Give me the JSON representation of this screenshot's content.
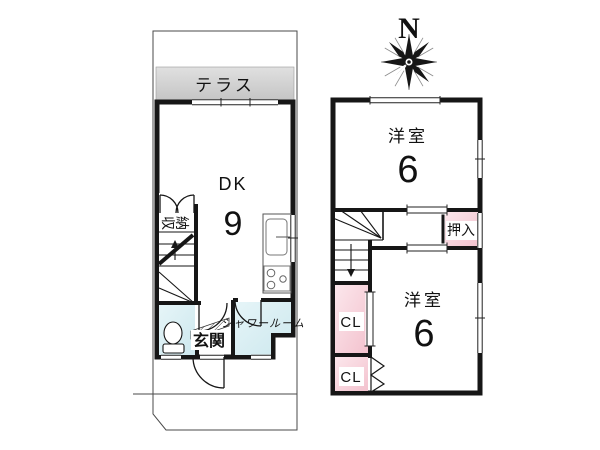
{
  "compass": {
    "north": "N"
  },
  "floor1": {
    "terrace_label": "テラス",
    "dk_label": "DK",
    "dk_size": "9",
    "storage_label": "収納",
    "genkan_label": "玄関",
    "shower_label": "シャワールーム"
  },
  "floor2": {
    "room_top_label": "洋室",
    "room_top_size": "6",
    "oshiire_label": "押入",
    "closet_upper_label": "CL",
    "closet_lower_label": "CL",
    "room_bottom_label": "洋室",
    "room_bottom_size": "6"
  },
  "colors": {
    "wall": "#161616",
    "floor_light": "#faf0cd",
    "floor_tan": "#dfb46a",
    "wet_cyan": "#d9eef3",
    "closet_pink": "#f5c9d3",
    "terrace_gray": "#cccccc"
  }
}
